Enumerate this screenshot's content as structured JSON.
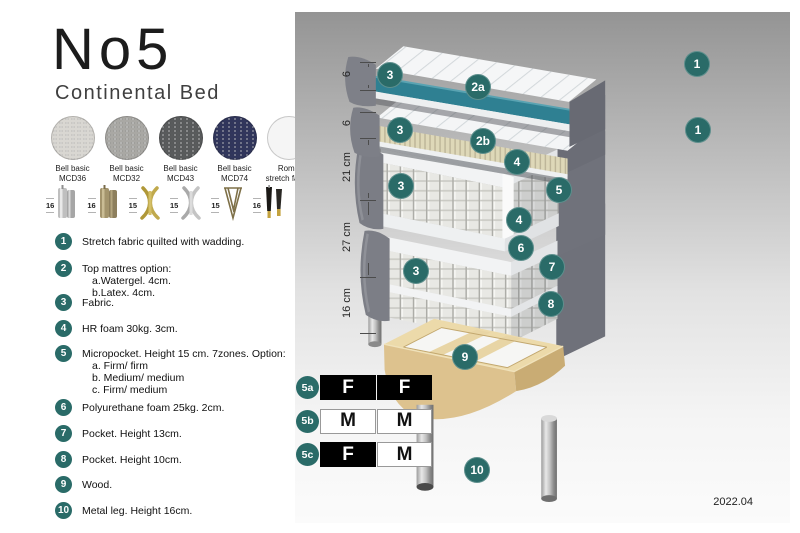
{
  "header": {
    "title": "No5",
    "subtitle": "Continental Bed"
  },
  "fabric_swatches": [
    {
      "line1": "Bell basic",
      "line2": "MCD36",
      "color": "#d9d7d2",
      "texture": true
    },
    {
      "line1": "Bell basic",
      "line2": "MCD32",
      "color": "#a9a8a4",
      "texture": true
    },
    {
      "line1": "Bell basic",
      "line2": "MCD43",
      "color": "#595b5c",
      "texture": true
    },
    {
      "line1": "Bell basic",
      "line2": "MCD74",
      "color": "#31365c",
      "texture": true
    },
    {
      "line1": "Roma",
      "line2": "stretch fabric",
      "color": "#f5f5f5",
      "texture": false
    }
  ],
  "leg_options": [
    {
      "height": "16",
      "style": "cylinder-silver"
    },
    {
      "height": "16",
      "style": "cylinder-brass"
    },
    {
      "height": "15",
      "style": "twist-gold"
    },
    {
      "height": "15",
      "style": "twist-silver"
    },
    {
      "height": "15",
      "style": "hairpin"
    },
    {
      "height": "16",
      "style": "tapered-black-gold"
    }
  ],
  "parts_list": [
    {
      "num": "1",
      "text": "Stretch fabric quilted with wadding.",
      "options": []
    },
    {
      "num": "2",
      "text": "Top mattres option:",
      "options": [
        "a.Watergel. 4cm.",
        "b.Latex. 4cm."
      ]
    },
    {
      "num": "3",
      "text": "Fabric.",
      "options": []
    },
    {
      "num": "4",
      "text": "HR foam 30kg. 3cm.",
      "options": []
    },
    {
      "num": "5",
      "text": "Micropocket. Height 15 cm. 7zones. Option:",
      "options": [
        "a. Firm/ firm",
        "b. Medium/ medium",
        "c. Firm/ medium"
      ]
    },
    {
      "num": "6",
      "text": "Polyurethane foam 25kg. 2cm.",
      "options": []
    },
    {
      "num": "7",
      "text": "Pocket. Height 13cm.",
      "options": []
    },
    {
      "num": "8",
      "text": "Pocket. Height 10cm.",
      "options": []
    },
    {
      "num": "9",
      "text": "Wood.",
      "options": []
    },
    {
      "num": "10",
      "text": "Metal leg. Height 16cm.",
      "options": []
    }
  ],
  "diagram": {
    "measurements": [
      "6",
      "6",
      "21 cm",
      "27 cm",
      "16 cm"
    ],
    "callouts": [
      "1",
      "3",
      "2a",
      "1",
      "3",
      "2b",
      "4",
      "3",
      "5",
      "4",
      "6",
      "7",
      "3",
      "8",
      "9",
      "10"
    ],
    "firmness_table": [
      {
        "label": "5a",
        "cells": [
          {
            "text": "F",
            "variant": "dark"
          },
          {
            "text": "F",
            "variant": "dark"
          }
        ]
      },
      {
        "label": "5b",
        "cells": [
          {
            "text": "M",
            "variant": "light"
          },
          {
            "text": "M",
            "variant": "light"
          }
        ]
      },
      {
        "label": "5c",
        "cells": [
          {
            "text": "F",
            "variant": "dark"
          },
          {
            "text": "M",
            "variant": "light"
          }
        ]
      }
    ],
    "version": "2022.04"
  },
  "colors": {
    "accent_teal": "#2a6b68",
    "watergel_teal": "#2f8092",
    "fabric_gray": "#73757d",
    "latex_cream": "#ded8b6",
    "wood": "#e7d4a6"
  }
}
